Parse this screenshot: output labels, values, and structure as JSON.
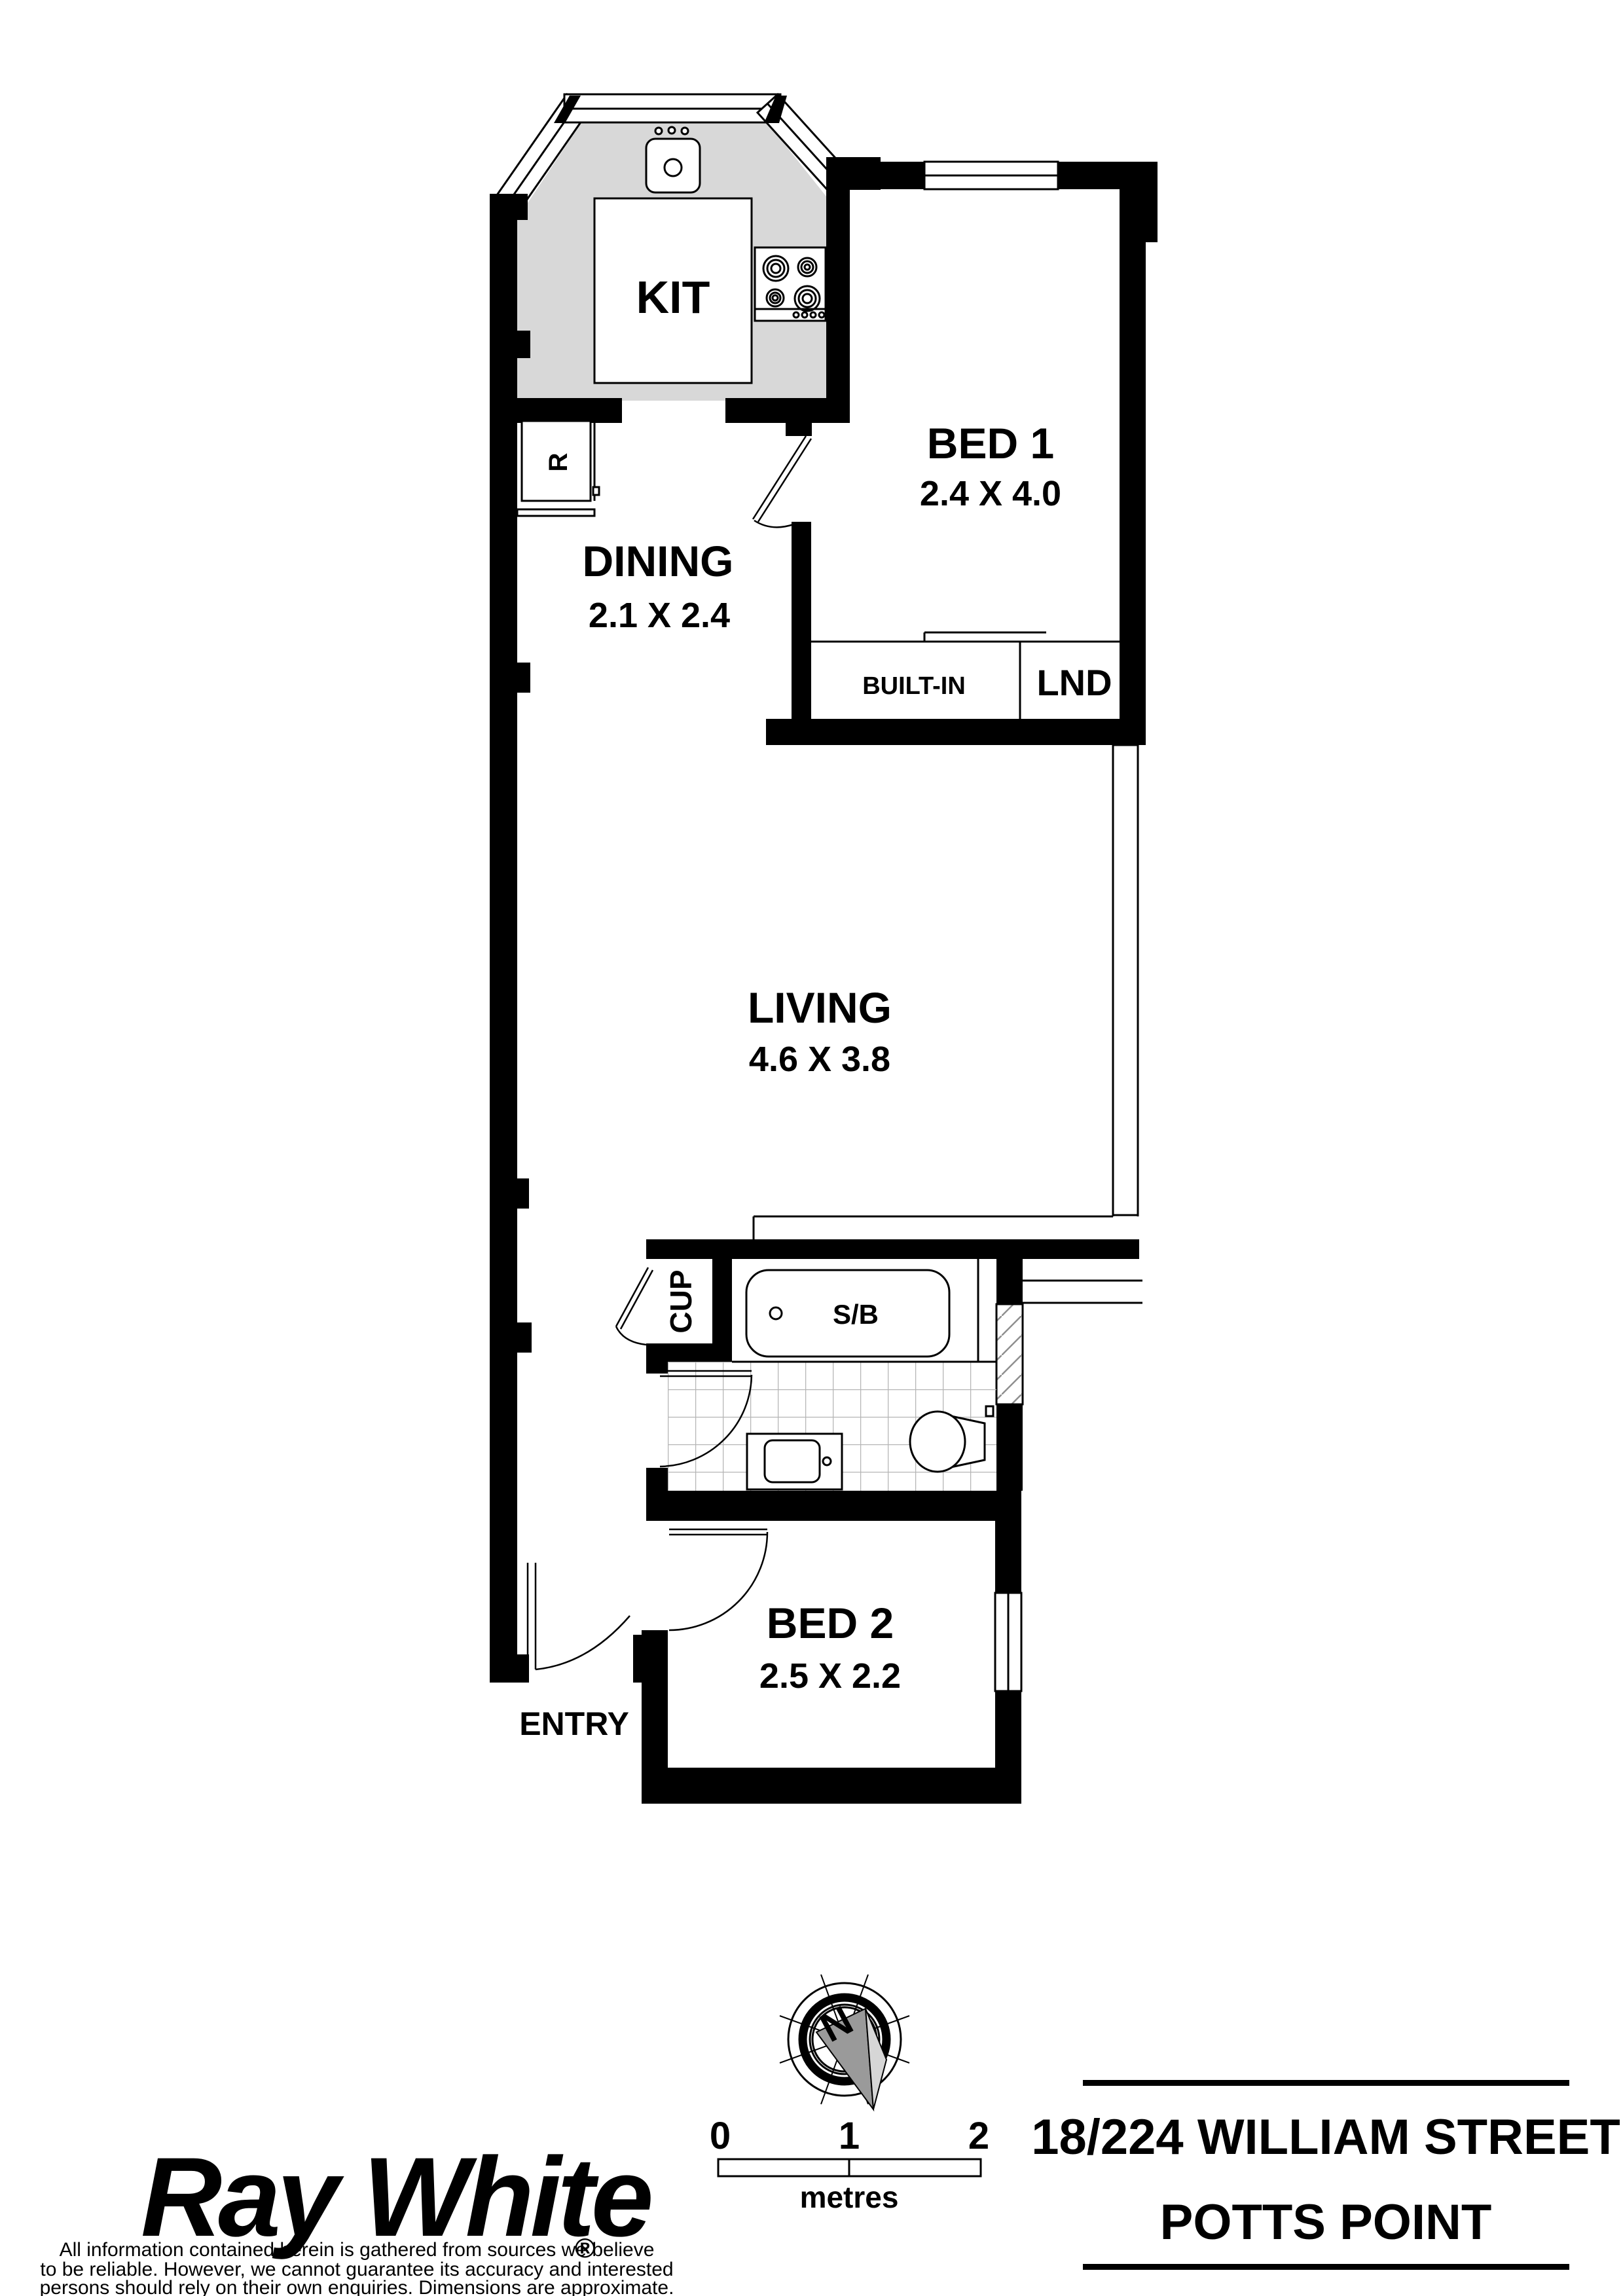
{
  "plan": {
    "rooms": {
      "kitchen": {
        "label": "KIT"
      },
      "bed1": {
        "label": "BED 1",
        "dims": "2.4 X 4.0"
      },
      "dining": {
        "label": "DINING",
        "dims": "2.1 X 2.4"
      },
      "living": {
        "label": "LIVING",
        "dims": "4.6 X 3.8"
      },
      "bed2": {
        "label": "BED 2",
        "dims": "2.5 X 2.2"
      },
      "entry": {
        "label": "ENTRY"
      }
    },
    "features": {
      "built_in": {
        "label": "BUILT-IN"
      },
      "laundry": {
        "label": "LND"
      },
      "cupboard": {
        "label": "CUP"
      },
      "shower_bath": {
        "label": "S/B"
      },
      "refrigerator": {
        "label": "R"
      }
    }
  },
  "compass": {
    "north_label": "N"
  },
  "scale_bar": {
    "tick0": "0",
    "tick1": "1",
    "tick2": "2",
    "unit_label": "metres"
  },
  "branding": {
    "logo_text": "Ray White",
    "registered_mark": "®",
    "logo_color": "#8a8a8a"
  },
  "address": {
    "line1": "18/224 WILLIAM STREET",
    "line2": "POTTS POINT"
  },
  "disclaimer": {
    "line1": "All information contained herein is gathered from sources we believe",
    "line2": "to be reliable. However, we cannot guarantee its accuracy and interested",
    "line3": "persons should rely on their own enquiries. Dimensions are approximate."
  },
  "colors": {
    "benchtop": "#d8d8d8",
    "tile_line": "#b5b5b5",
    "needle_dark": "#9a9a9a",
    "needle_light": "#d6d6d6"
  }
}
